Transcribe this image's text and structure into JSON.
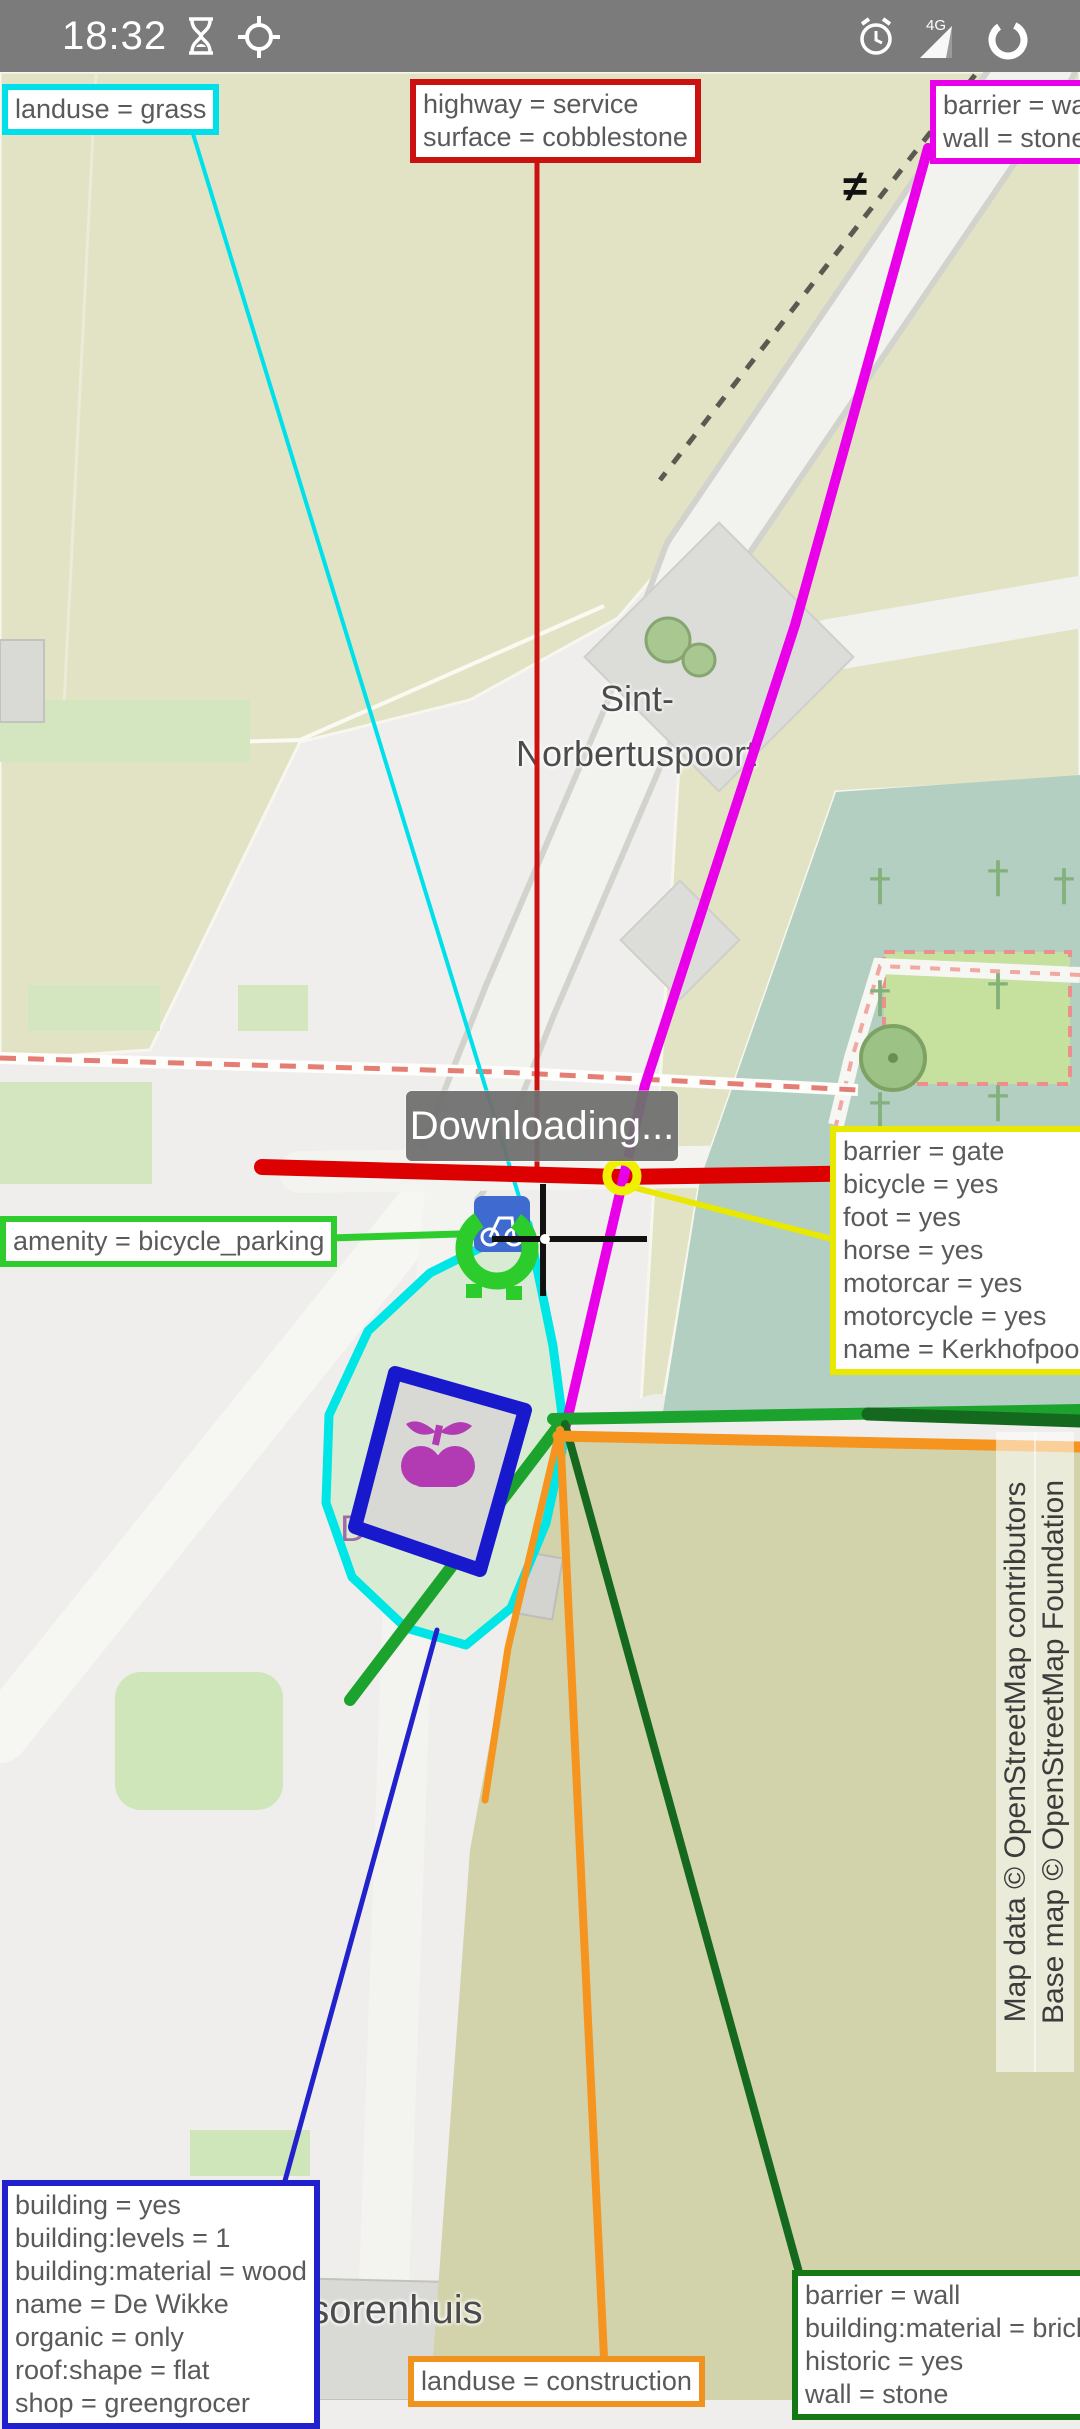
{
  "status_bar": {
    "time": "18:32",
    "network": "4G",
    "icons": [
      "hourglass-icon",
      "gps-searching-icon",
      "alarm-icon",
      "signal-icon",
      "data-circle-icon"
    ]
  },
  "toast": {
    "message": "Downloading..."
  },
  "map_labels": {
    "plaza_line1": "Sint-",
    "plaza_line2": "Norbertuspoort",
    "shop": "De Wikke",
    "building_partial": "risorenhuis"
  },
  "symbols": {
    "barrier_marker": "≠"
  },
  "attribution": {
    "line1": "Map data © OpenStreetMap contributors",
    "line2": "Base map © OpenStreetMap Foundation"
  },
  "colors": {
    "grass_callout": "#00e0ea",
    "service_callout": "#cc1111",
    "wall_callout": "#e800e8",
    "gate_callout": "#e8e800",
    "bicycle_callout": "#2ecc2e",
    "building_callout": "#2020cc",
    "construction_callout": "#f0921e",
    "historic_wall_callout": "#157815",
    "selected_road": "#dd0000",
    "selected_wall": "#e800e8",
    "cemetery_fill": "#b3cfc1",
    "grass_fill": "#e2e3c4"
  },
  "callouts": [
    {
      "name": "landuse-grass",
      "lines": [
        "landuse = grass"
      ]
    },
    {
      "name": "highway-service",
      "lines": [
        "highway = service",
        "surface = cobblestone"
      ]
    },
    {
      "name": "barrier-wall-top",
      "lines": [
        "barrier = wall",
        "wall = stone"
      ]
    },
    {
      "name": "barrier-gate",
      "lines": [
        "barrier = gate",
        "bicycle = yes",
        "foot = yes",
        "horse = yes",
        "motorcar = yes",
        "motorcycle = yes",
        "name = Kerkhofpoort"
      ]
    },
    {
      "name": "amenity-bicycle-parking",
      "lines": [
        "amenity = bicycle_parking"
      ]
    },
    {
      "name": "building-de-wikke",
      "lines": [
        "building = yes",
        "building:levels = 1",
        "building:material = wood",
        "name = De Wikke",
        "organic = only",
        "roof:shape = flat",
        "shop = greengrocer"
      ]
    },
    {
      "name": "landuse-construction",
      "lines": [
        "landuse = construction"
      ]
    },
    {
      "name": "barrier-wall-bottom",
      "lines": [
        "barrier = wall",
        "building:material = brick",
        "historic = yes",
        "wall = stone"
      ]
    }
  ]
}
